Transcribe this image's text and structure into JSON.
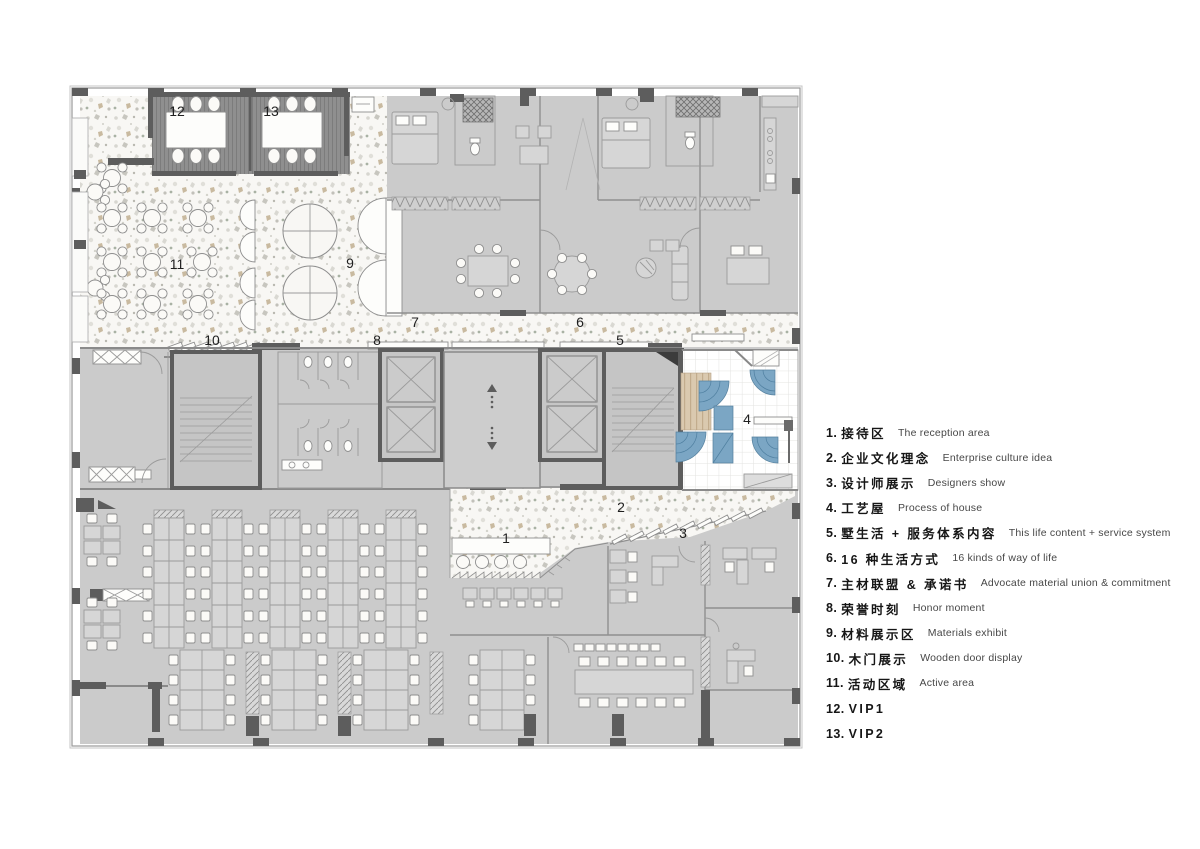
{
  "title": "Office showroom floor plan",
  "colors": {
    "accent_blue": "#7ba6c4",
    "room_gray": "#cbcbcb",
    "wall_dark": "#5d5d5d",
    "terrazzo_base": "#f8f7f4",
    "vip_floor": "#8f8f8f",
    "wood": "#dac9af"
  },
  "plan": {
    "labels": [
      {
        "text": "1"
      },
      {
        "text": "2"
      },
      {
        "text": "3"
      },
      {
        "text": "4"
      },
      {
        "text": "5"
      },
      {
        "text": "6"
      },
      {
        "text": "7"
      },
      {
        "text": "8"
      },
      {
        "text": "9"
      },
      {
        "text": "10"
      },
      {
        "text": "11"
      },
      {
        "text": "12"
      },
      {
        "text": "13"
      }
    ]
  },
  "legend": {
    "items": [
      {
        "num": "1.",
        "zh": "接待区",
        "en": "The reception area"
      },
      {
        "num": "2.",
        "zh": "企业文化理念",
        "en": "Enterprise culture idea"
      },
      {
        "num": "3.",
        "zh": "设计师展示",
        "en": "Designers show"
      },
      {
        "num": "4.",
        "zh": "工艺屋",
        "en": "Process of house"
      },
      {
        "num": "5.",
        "zh": "墅生活 + 服务体系内容",
        "en": "This life content + service system"
      },
      {
        "num": "6.",
        "zh": "16 种生活方式",
        "en": "16 kinds of way of life"
      },
      {
        "num": "7.",
        "zh": "主材联盟 & 承诺书",
        "en": "Advocate material union & commitment"
      },
      {
        "num": "8.",
        "zh": "荣誉时刻",
        "en": "Honor moment"
      },
      {
        "num": "9.",
        "zh": "材料展示区",
        "en": "Materials exhibit"
      },
      {
        "num": "10.",
        "zh": "木门展示",
        "en": "Wooden door display"
      },
      {
        "num": "11.",
        "zh": "活动区域",
        "en": "Active area"
      },
      {
        "num": "12.",
        "zh": "VIP1",
        "en": ""
      },
      {
        "num": "13.",
        "zh": "VIP2",
        "en": ""
      }
    ]
  }
}
